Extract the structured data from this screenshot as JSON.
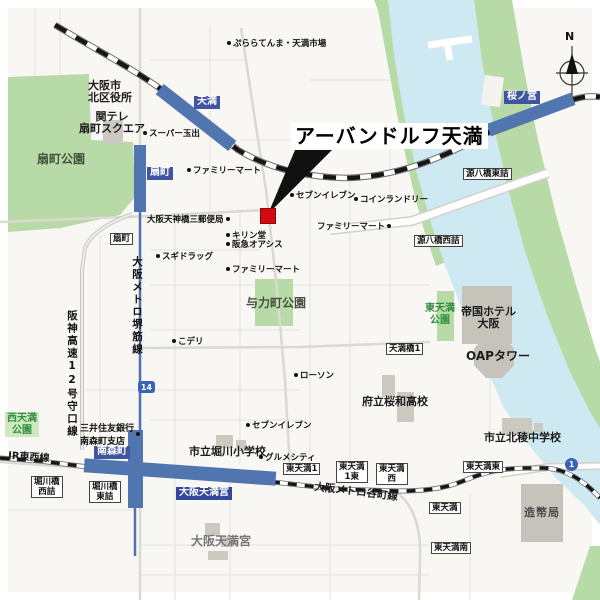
{
  "map": {
    "title": "アーバンドルフ天満",
    "compass_label": "N",
    "marker_color": "#d40a12",
    "station_bar_color": "#5176af",
    "station_label_color": "#3f55a2",
    "water_color": "#cfe9f3",
    "park_color": "#b7daa7",
    "stations": {
      "temma": "天満",
      "sakuranomiya": "桜ノ宮",
      "ogimachi": "扇町",
      "minamimorimachi": "南森町",
      "osakatemmangu": "大阪天満宮"
    },
    "lines": {
      "jr_tozai": "JR東西線",
      "tanimachi": "大阪メトロ谷町線",
      "sakaisuji": "大阪メトロ堺筋線",
      "hanshin_exp": "阪神高速12号守口線"
    },
    "route_shields": {
      "r14": "14",
      "r1": "1"
    },
    "parks": {
      "ogimachi_park": "扇町公園",
      "yorikicho_park": "与力町公園",
      "nishitemma_park": "西天満\n公園",
      "higashitemma_park": "東天満\n公園"
    },
    "facilities": {
      "kita_ward_office": "大阪市\n北区役所",
      "kantele_square": "関テレ\n扇町スクエア",
      "imperial_hotel": "帝国ホテル\n大阪",
      "oap_tower": "OAPタワー",
      "owa_hs": "府立桜和高校",
      "horikawa_es": "市立堀川小学校",
      "hokuryo_jhs": "市立北稜中学校",
      "mint": "造幣局",
      "temmangu_shrine": "大阪天満宮",
      "smbc": "三井住友銀行\n南森町支店"
    },
    "pois": {
      "purara_temma": "ぷららてんま・天満市場",
      "super_tamade": "スーパー玉出",
      "familymart_north": "ファミリーマート",
      "seven_center": "セブンイレブン",
      "coin_laundry": "コインランドリー",
      "familymart_east": "ファミリーマート",
      "post_office": "大阪天神橋三郵便局",
      "kirindo": "キリン堂",
      "hankyu_oasis": "阪急オアシス",
      "sugi_drug": "スギドラッグ",
      "familymart_center": "ファミリーマート",
      "kodeli": "こデリ",
      "lawson": "ローソン",
      "seven_south": "セブンイレブン",
      "gourmet_city": "グルメシティ"
    },
    "intersections": {
      "ogimachi": "扇町",
      "genpachibashi_higashi": "源八橋東詰",
      "genpachibashi_nishi": "源八橋西詰",
      "temmabashi1": "天満橋1",
      "horikawabashi_nishi": "堀川橋\n西詰",
      "horikawabashi_higashi": "堀川橋\n東詰",
      "higashitemma1": "東天満1",
      "higashitemma1_higashi": "東天満\n1東",
      "higashitemma_nishi": "東天満\n西",
      "higashitemma_higashi": "東天満東",
      "higashitemma": "東天満",
      "higashitemma_minami": "東天満南"
    }
  }
}
